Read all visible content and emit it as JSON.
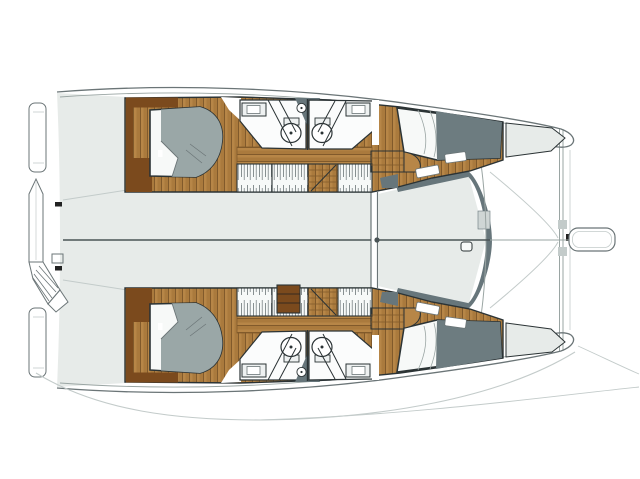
{
  "document": {
    "kind": "boat-floor-plan",
    "subject": "catamaran-accommodation-and-deck-plan",
    "orientation": "bow-right-stern-left"
  },
  "colors": {
    "background": "#ffffff",
    "deck": "#e7ebe9",
    "deck_line": "#9aa5a3",
    "outline": "#6b7577",
    "faint": "#c3cbca",
    "dark_stroke": "#2b3335",
    "wood": "#b78647",
    "wood_shade": "#aa7a3d",
    "wood_line": "#815a2b",
    "wood_dark": "#7b4a1d",
    "mattress": "#9aa7a7",
    "mattress_dark": "#6d7c80",
    "bedding": "#f7f9f8",
    "charcoal": "#67767b",
    "bath": "#fbfcfc",
    "fixture": "#eef1f1",
    "hanger_stroke": "#6b7577",
    "centerline": "#4a5456",
    "black": "#222222",
    "white": "#ffffff",
    "notch": "#cfd6d5"
  },
  "components": {
    "hulls": [
      "port-hull",
      "starboard-hull"
    ],
    "per_hull": [
      "aft-double-berth",
      "aft-bathroom",
      "forward-bathroom",
      "wardrobes",
      "companionway-steps",
      "forward-double-berth",
      "anchor-locker",
      "transom-platform"
    ],
    "center": [
      "bridgedeck",
      "forward-bulkhead",
      "foredeck",
      "forward-crossbeam",
      "bowsprit",
      "stern-davit-arm",
      "stern-steps-fan",
      "centerline"
    ],
    "fixtures": [
      "sink-counter",
      "toilet",
      "twin-basins",
      "shower-partition",
      "hanging-lockers",
      "drawer-unit"
    ]
  }
}
